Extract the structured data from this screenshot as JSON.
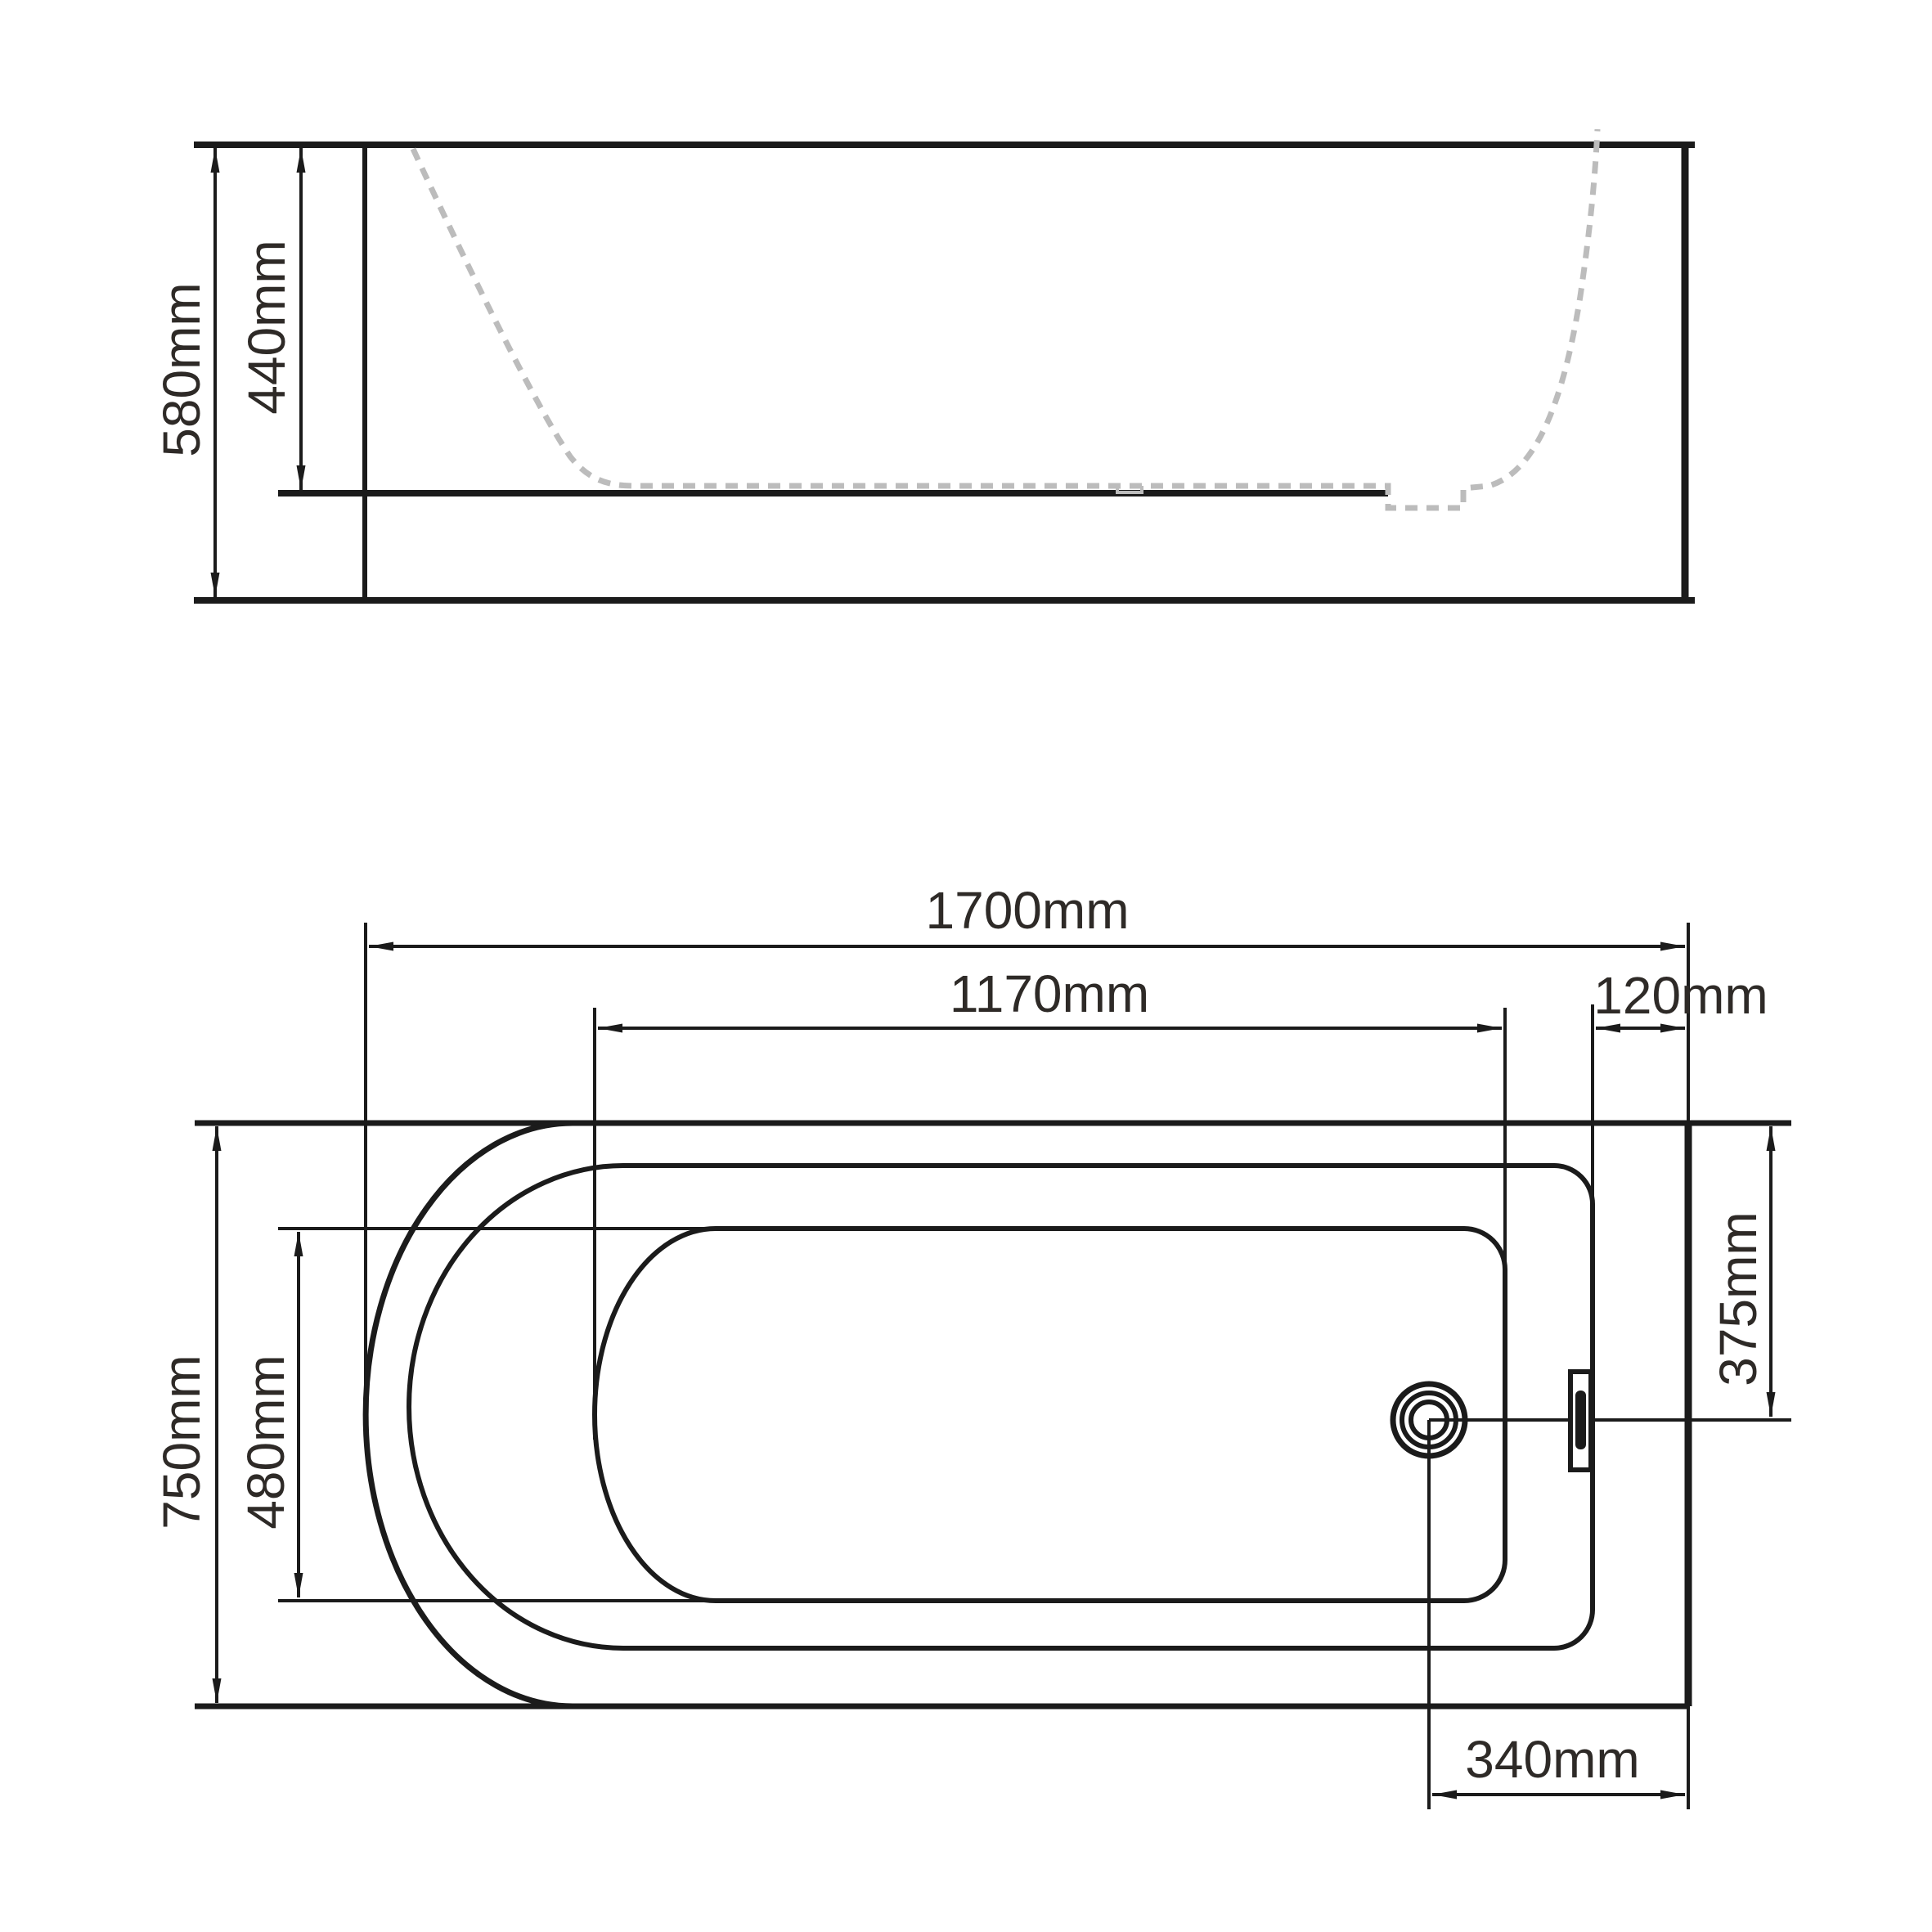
{
  "colors": {
    "line": "#1b1b1b",
    "dashed_profile": "#bcbcbc",
    "text": "#2e2a27",
    "background": "#ffffff"
  },
  "side_view": {
    "overall_height": "580mm",
    "internal_depth": "440mm"
  },
  "plan_view": {
    "overall_length": "1700mm",
    "internal_length": "1170mm",
    "rim_width_right": "120mm",
    "overall_width": "750mm",
    "internal_width": "480mm",
    "drain_offset_from_top": "375mm",
    "drain_offset_from_end": "340mm"
  }
}
